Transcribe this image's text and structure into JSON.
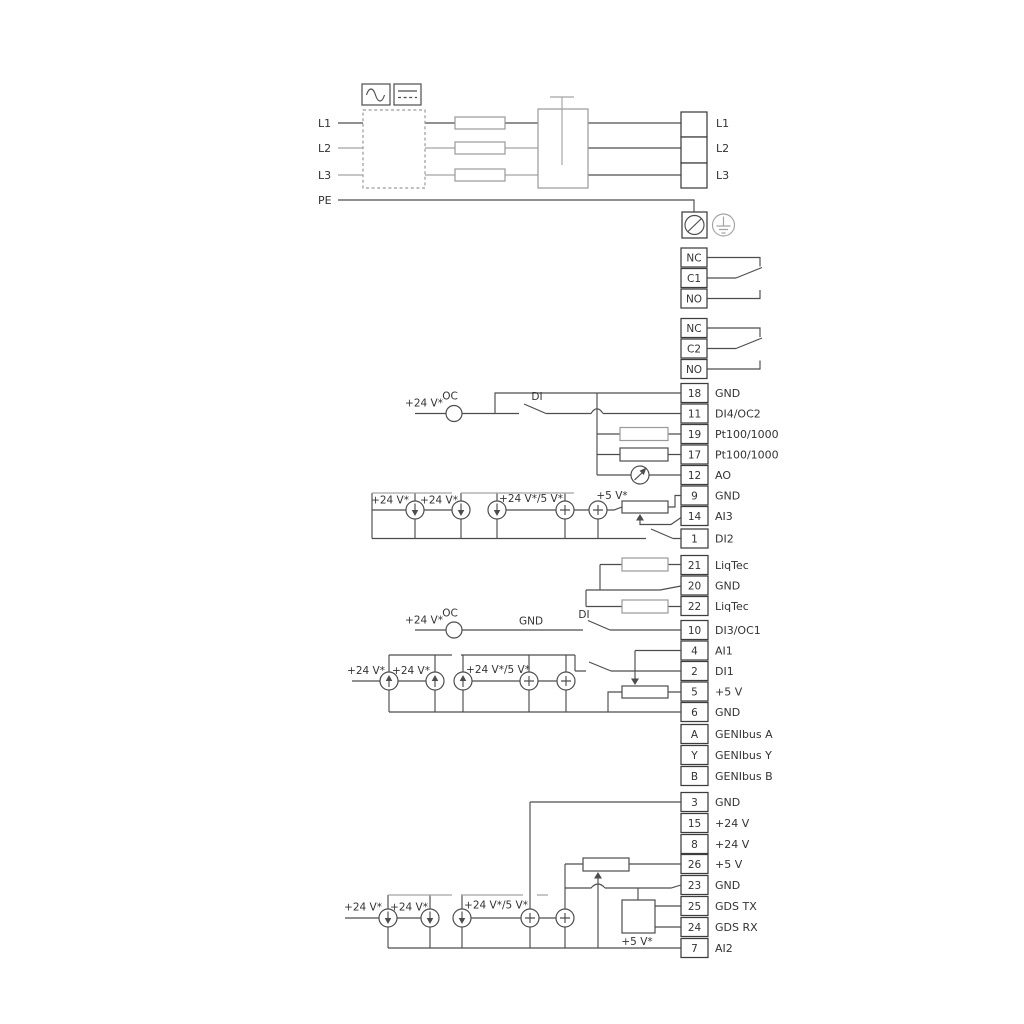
{
  "mains": {
    "inputs": [
      "L1",
      "L2",
      "L3",
      "PE"
    ],
    "outputs": [
      "L1",
      "L2",
      "L3"
    ]
  },
  "relay1": {
    "terminals": [
      "NC",
      "C1",
      "NO"
    ]
  },
  "relay2": {
    "terminals": [
      "NC",
      "C2",
      "NO"
    ]
  },
  "strip1": {
    "annotations": {
      "v24": "+24 V*",
      "oc": "OC",
      "di": "DI"
    },
    "sources": {
      "a": "+24 V*",
      "b": "+24 V*",
      "c": "+24 V*/5 V*",
      "d": "+5 V*"
    },
    "terminals": [
      {
        "num": "18",
        "label": "GND"
      },
      {
        "num": "11",
        "label": "DI4/OC2"
      },
      {
        "num": "19",
        "label": "Pt100/1000"
      },
      {
        "num": "17",
        "label": "Pt100/1000"
      },
      {
        "num": "12",
        "label": "AO"
      },
      {
        "num": "9",
        "label": "GND"
      },
      {
        "num": "14",
        "label": "AI3"
      },
      {
        "num": "1",
        "label": "DI2"
      }
    ]
  },
  "strip2": {
    "terminals": [
      {
        "num": "21",
        "label": "LiqTec"
      },
      {
        "num": "20",
        "label": "GND"
      },
      {
        "num": "22",
        "label": "LiqTec"
      }
    ]
  },
  "strip3": {
    "annotations": {
      "v24": "+24 V*",
      "oc": "OC",
      "gnd": "GND",
      "di": "DI"
    },
    "sources": {
      "a": "+24 V*",
      "b": "+24 V*",
      "c": "+24 V*/5 V*"
    },
    "terminals": [
      {
        "num": "10",
        "label": "DI3/OC1"
      },
      {
        "num": "4",
        "label": "AI1"
      },
      {
        "num": "2",
        "label": "DI1"
      },
      {
        "num": "5",
        "label": "+5 V"
      },
      {
        "num": "6",
        "label": "GND"
      },
      {
        "num": "A",
        "label": "GENIbus A"
      },
      {
        "num": "Y",
        "label": "GENIbus Y"
      },
      {
        "num": "B",
        "label": "GENIbus B"
      }
    ]
  },
  "strip4": {
    "sources": {
      "a": "+24 V*",
      "b": "+24 V*",
      "c": "+24 V*/5 V*",
      "d": "+5 V*"
    },
    "terminals": [
      {
        "num": "3",
        "label": "GND"
      },
      {
        "num": "15",
        "label": "+24 V"
      },
      {
        "num": "8",
        "label": "+24 V"
      },
      {
        "num": "26",
        "label": "+5 V"
      },
      {
        "num": "23",
        "label": "GND"
      },
      {
        "num": "25",
        "label": "GDS TX"
      },
      {
        "num": "24",
        "label": "GDS RX"
      },
      {
        "num": "7",
        "label": "AI2"
      }
    ]
  },
  "colors": {
    "wire": "#4d4d4d",
    "gray_wire": "#a3a3a3",
    "text": "#333333",
    "background": "#ffffff"
  }
}
